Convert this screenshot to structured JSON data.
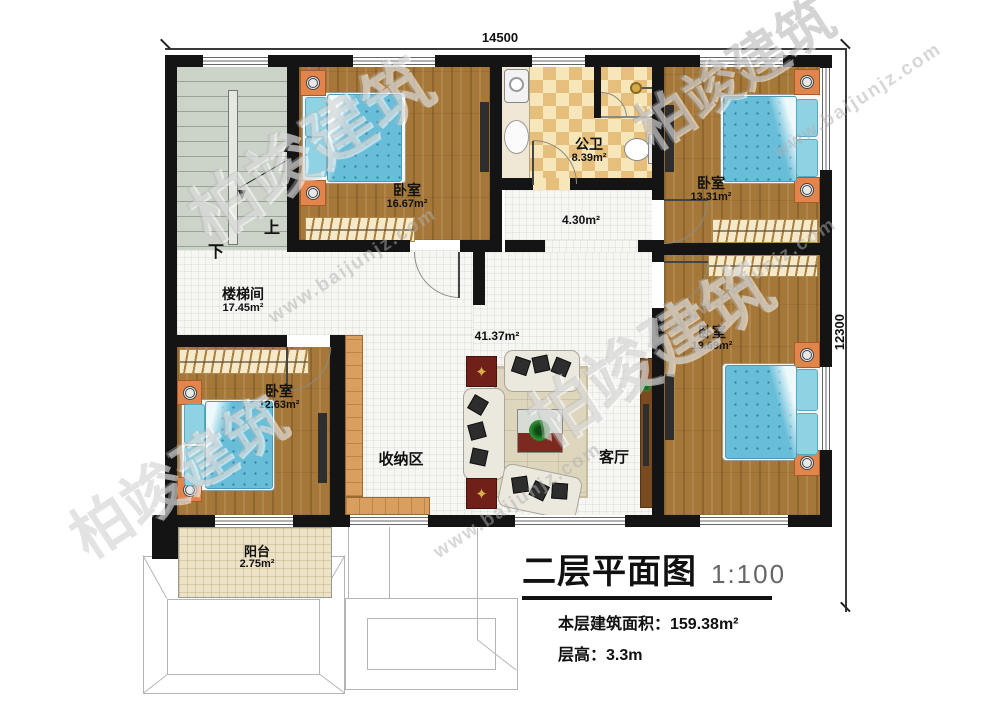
{
  "dimensions": {
    "width_label": "14500",
    "height_label": "12300"
  },
  "rooms": {
    "stairwell": {
      "label": "楼梯间",
      "area": "17.45m²"
    },
    "bedroom_top_left": {
      "label": "卧室",
      "area": "16.67m²"
    },
    "bathroom": {
      "label": "公卫",
      "area": "8.39m²"
    },
    "hallway": {
      "area": "4.30m²"
    },
    "bedroom_top_right": {
      "label": "卧室",
      "area": "13.31m²"
    },
    "bedroom_right": {
      "label": "卧室",
      "area": "19.69m²"
    },
    "bedroom_bottom_left": {
      "label": "卧室",
      "area": "12.63m²"
    },
    "storage": {
      "label": "收纳区"
    },
    "living": {
      "label": "客厅",
      "area": "41.37m²"
    },
    "balcony": {
      "label": "阳台",
      "area": "2.75m²"
    }
  },
  "stairs": {
    "up_label": "上",
    "down_label": "下"
  },
  "title_block": {
    "title": "二层平面图",
    "scale": "1:100",
    "floor_area": "本层建筑面积：159.38m²",
    "floor_height": "层高：3.3m"
  },
  "watermark": {
    "brand": "柏竣建筑",
    "site": "www.baijunjz.com"
  },
  "icons": {
    "mat_star": "✦"
  }
}
